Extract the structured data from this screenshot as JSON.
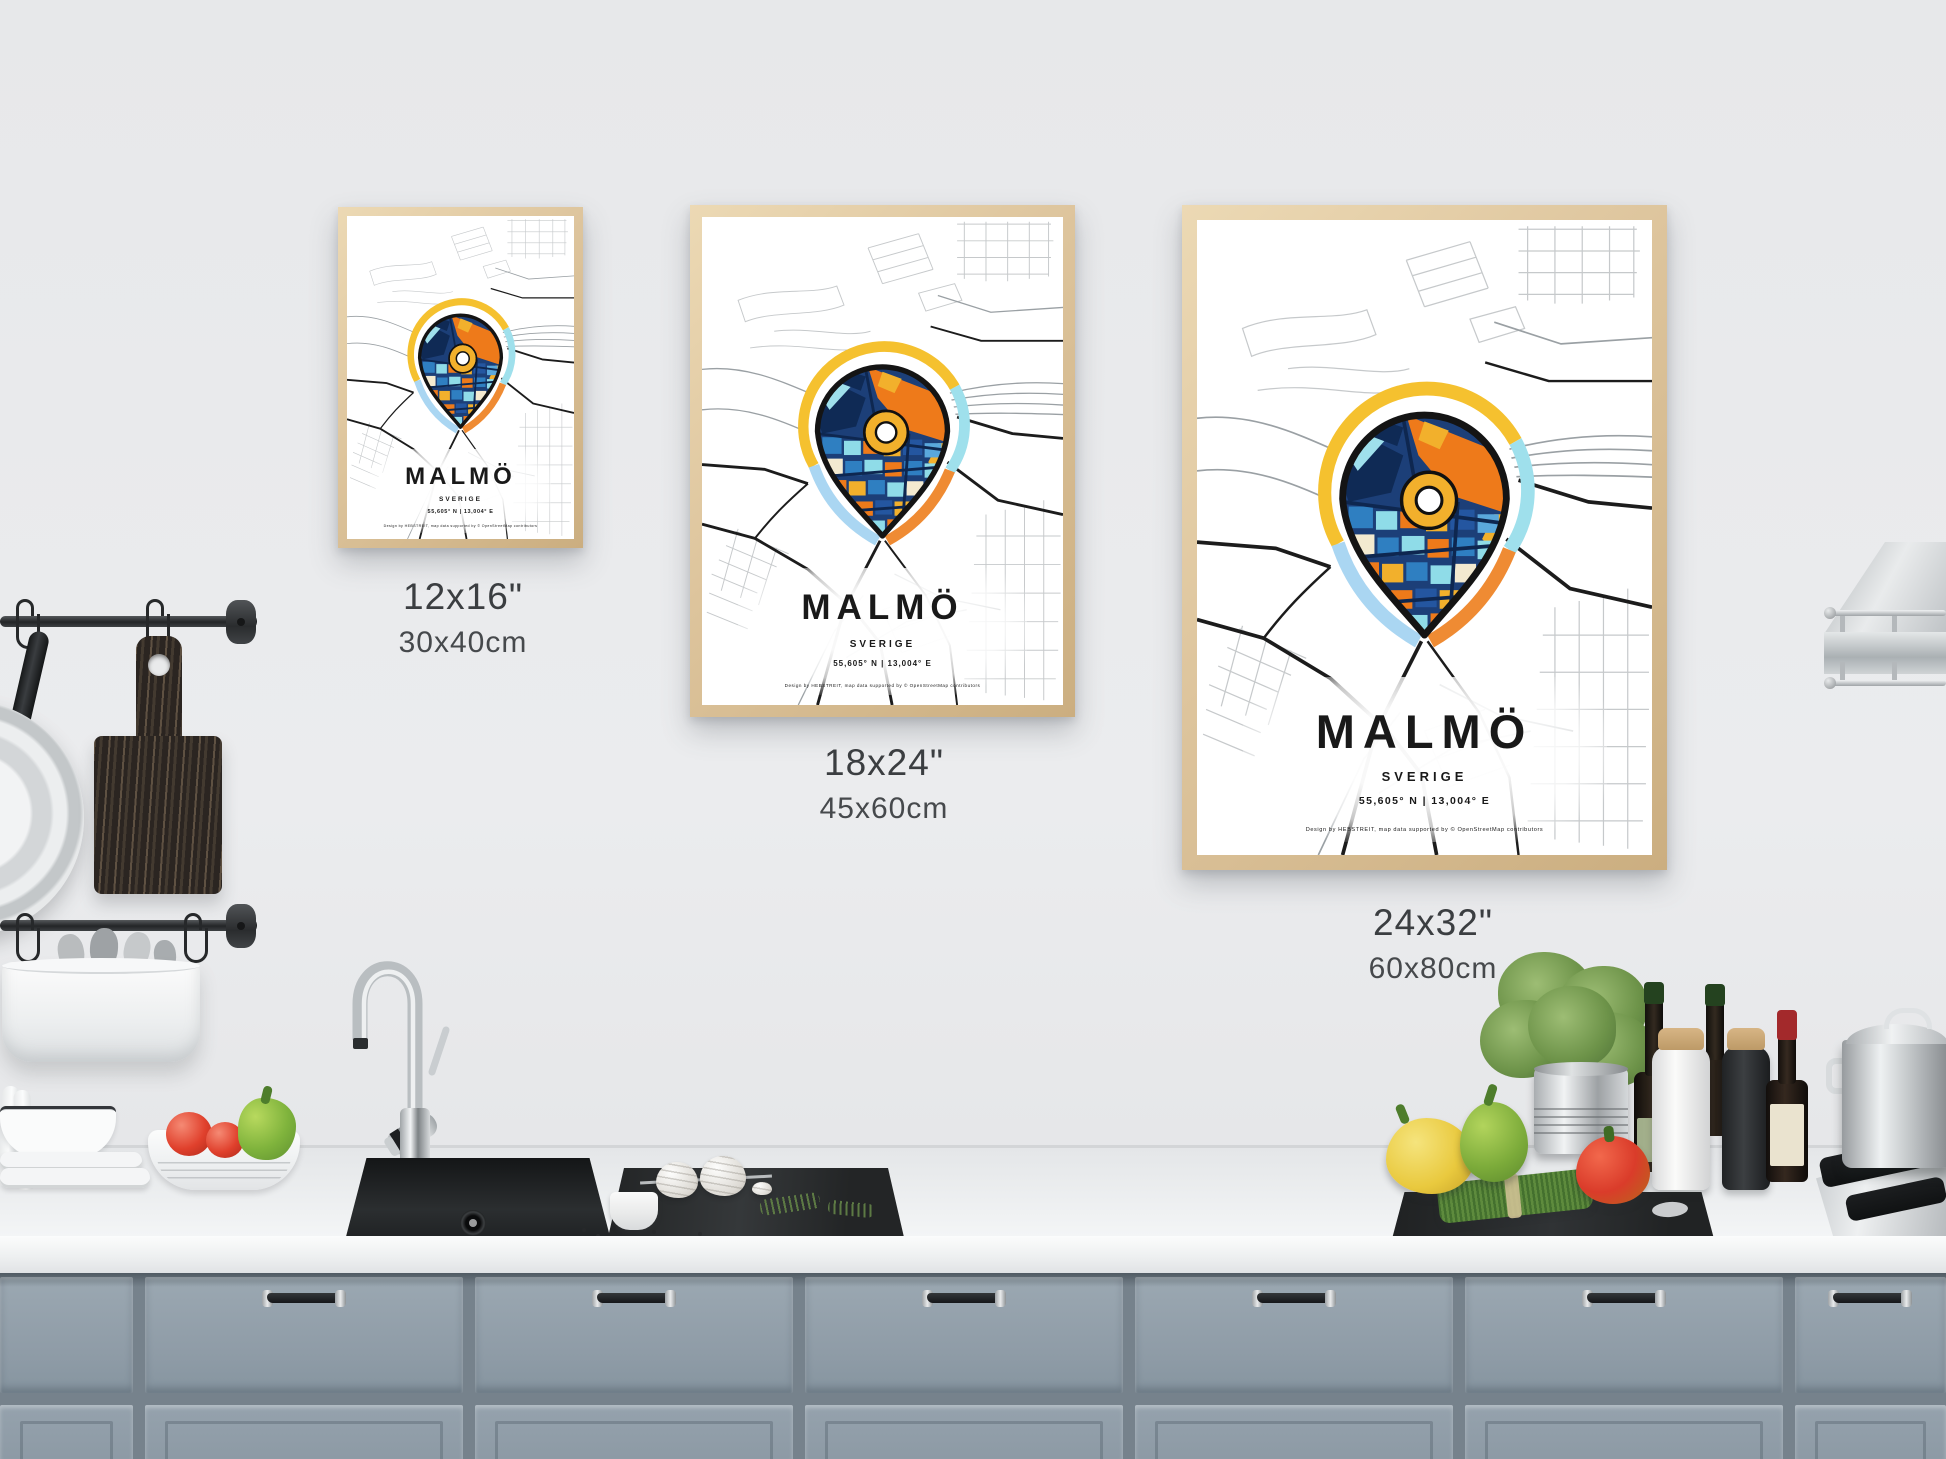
{
  "posters": [
    {
      "city": "MALMÖ",
      "country": "SVERIGE",
      "coordinates": "55,605° N | 13,004° E",
      "credit": "Design by HEBSTREIT, map data supported by © OpenStreetMap contributors",
      "size_in": "12x16\"",
      "size_cm": "30x40cm"
    },
    {
      "city": "MALMÖ",
      "country": "SVERIGE",
      "coordinates": "55,605° N | 13,004° E",
      "credit": "Design by HEBSTREIT, map data supported by © OpenStreetMap contributors",
      "size_in": "18x24\"",
      "size_cm": "45x60cm"
    },
    {
      "city": "MALMÖ",
      "country": "SVERIGE",
      "coordinates": "55,605° N | 13,004° E",
      "credit": "Design by HEBSTREIT, map data supported by © OpenStreetMap contributors",
      "size_in": "24x32\"",
      "size_cm": "60x80cm"
    }
  ],
  "colors": {
    "wall": "#e9eaec",
    "frame_wood": "#ddc49c",
    "cabinet": "#93a0ab",
    "pin_navy": "#1c3f78",
    "pin_orange": "#ee7a1a",
    "pin_yellow": "#f2b02c",
    "pin_cyan": "#8fdce8",
    "halo_yellow": "#f5c12f",
    "halo_cyan": "#9fe0ec",
    "halo_orange": "#ef8b33",
    "halo_blue": "#aad6f2"
  }
}
